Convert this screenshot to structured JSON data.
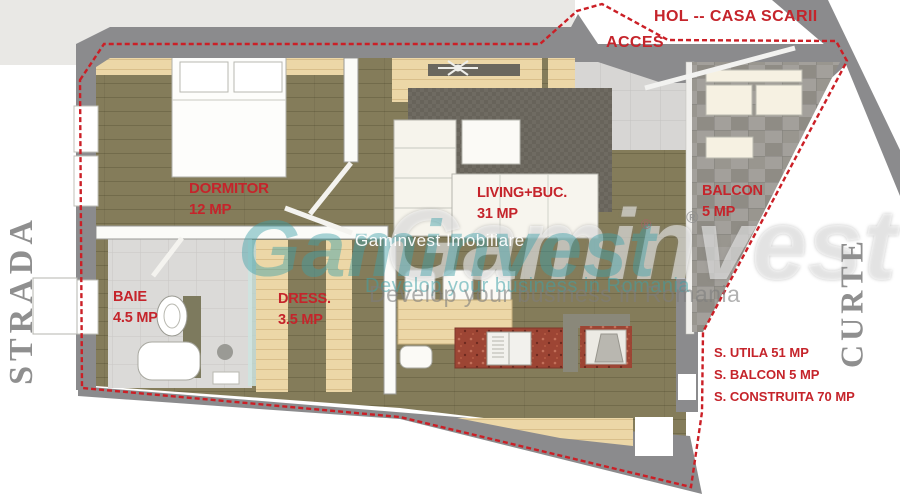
{
  "exterior": {
    "hol_label": "HOL -- CASA SCARII",
    "acces_label": "ACCES",
    "left_side": "STRADA",
    "right_side": "CURTE"
  },
  "rooms": [
    {
      "name": "DORMITOR",
      "area": "12 MP"
    },
    {
      "name": "LIVING+BUC.",
      "area": "31 MP"
    },
    {
      "name": "BALCON",
      "area": "5 MP"
    },
    {
      "name": "BAIE",
      "area": "4.5 MP"
    },
    {
      "name": "DRESS.",
      "area": "3.5 MP"
    }
  ],
  "areas_summary": {
    "utila": "S. UTILA 51 MP",
    "balcon": "S. BALCON 5 MP",
    "construita": "S. CONSTRUITA 70 MP"
  },
  "watermark": {
    "brand": "Gaminvest",
    "registered": "®",
    "title": "Gaminvest Imobiliare",
    "tagline": "Develop your business in Romania"
  },
  "colors": {
    "label_red": "#c5242b",
    "wall_gray": "#8b8b8d",
    "wood_floor": "#847c5a",
    "wood_light": "#ecd7a7",
    "tile_gray": "#dbdad8",
    "balcony_stone": "#a3a09b",
    "rug_gray": "#6f6b62",
    "counter_brick": "#9d4534",
    "watermark_teal": "#3ea0a8",
    "side_text_gray": "#8f8f8f"
  }
}
